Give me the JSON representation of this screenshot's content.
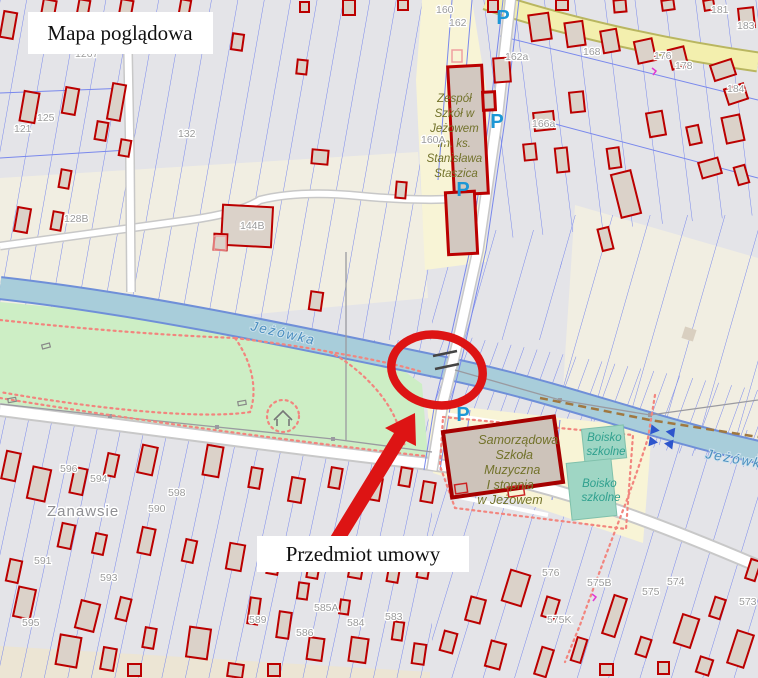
{
  "map": {
    "overlay": {
      "title": "Mapa poglądowa",
      "subject": "Przedmiot umowy"
    },
    "labels": {
      "school_top_lines": [
        "Zespół",
        "Szkół w",
        "Jeżowem",
        "im. ks.",
        "Stanisława",
        "Staszica"
      ],
      "music_school_lines": [
        "Samorządowa",
        "Szkoła",
        "Muzyczna",
        "I stopnia",
        "w Jeżowem"
      ],
      "sports_field_lines": [
        "Boisko",
        "szkolne"
      ],
      "river": "Jeżówka",
      "place": "Zanawsie",
      "parking_letter": "P"
    },
    "parcel_numbers": [
      {
        "label": "1267",
        "x": 75,
        "y": 57
      },
      {
        "label": "160",
        "x": 436,
        "y": 13
      },
      {
        "label": "162",
        "x": 449,
        "y": 26
      },
      {
        "label": "162a",
        "x": 505,
        "y": 60
      },
      {
        "label": "160A",
        "x": 421,
        "y": 143
      },
      {
        "label": "166a",
        "x": 532,
        "y": 127
      },
      {
        "label": "168",
        "x": 583,
        "y": 55
      },
      {
        "label": "176",
        "x": 654,
        "y": 59
      },
      {
        "label": "178",
        "x": 675,
        "y": 69
      },
      {
        "label": "181",
        "x": 711,
        "y": 13
      },
      {
        "label": "183",
        "x": 737,
        "y": 29
      },
      {
        "label": "184",
        "x": 727,
        "y": 92
      },
      {
        "label": "144B",
        "x": 240,
        "y": 229
      },
      {
        "label": "125",
        "x": 37,
        "y": 121
      },
      {
        "label": "121",
        "x": 14,
        "y": 132
      },
      {
        "label": "132",
        "x": 178,
        "y": 137
      },
      {
        "label": "128B",
        "x": 64,
        "y": 222
      },
      {
        "label": "596",
        "x": 60,
        "y": 472
      },
      {
        "label": "594",
        "x": 90,
        "y": 482
      },
      {
        "label": "598",
        "x": 168,
        "y": 496
      },
      {
        "label": "590",
        "x": 148,
        "y": 512
      },
      {
        "label": "591",
        "x": 34,
        "y": 564
      },
      {
        "label": "593",
        "x": 100,
        "y": 581
      },
      {
        "label": "595",
        "x": 22,
        "y": 626
      },
      {
        "label": "589",
        "x": 249,
        "y": 623
      },
      {
        "label": "585A",
        "x": 314,
        "y": 611
      },
      {
        "label": "586",
        "x": 296,
        "y": 636
      },
      {
        "label": "584",
        "x": 347,
        "y": 626
      },
      {
        "label": "583",
        "x": 385,
        "y": 620
      },
      {
        "label": "576",
        "x": 542,
        "y": 576
      },
      {
        "label": "575B",
        "x": 587,
        "y": 586
      },
      {
        "label": "575",
        "x": 642,
        "y": 595
      },
      {
        "label": "574",
        "x": 667,
        "y": 585
      },
      {
        "label": "575K",
        "x": 547,
        "y": 623
      },
      {
        "label": "573",
        "x": 739,
        "y": 605
      }
    ],
    "parking_icons": [
      {
        "x": 503,
        "y": 24
      },
      {
        "x": 497,
        "y": 128
      },
      {
        "x": 463,
        "y": 196
      },
      {
        "x": 463,
        "y": 421
      }
    ],
    "colors": {
      "annotation_red": "#dd1414",
      "parcel_blue": "#7988ec",
      "building_red": "#bb0000",
      "water": "#a8cdda",
      "park_green": "#cdeec5",
      "school_yellow": "#f8f4d6",
      "sports_field_teal": "#9fd6c4",
      "road_yellow": "#f3efae",
      "parking_blue": "#1d97d5",
      "background_grey": "#e4e4e8",
      "field_cream": "#f1eee2"
    }
  }
}
